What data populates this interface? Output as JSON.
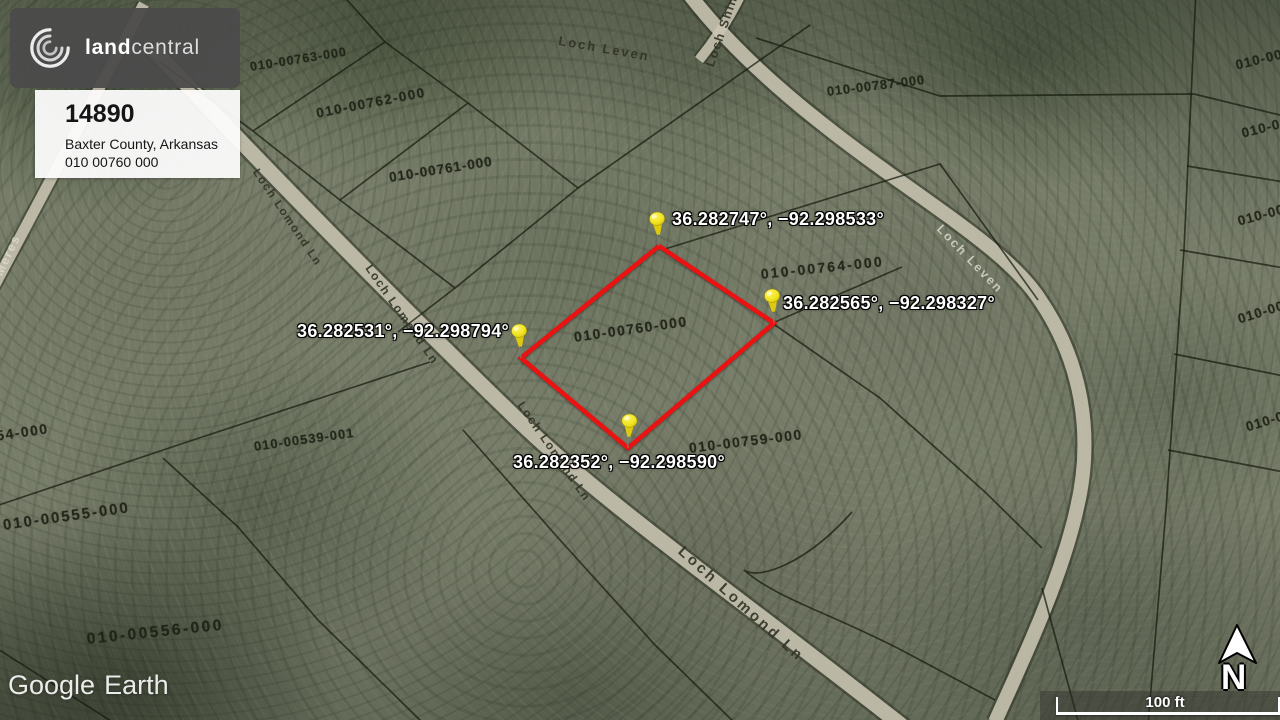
{
  "branding": {
    "logo_text_bold": "land",
    "logo_text_light": "central"
  },
  "listing": {
    "number": "14890",
    "location": "Baxter County, Arkansas",
    "parcel_id": "010 00760 000"
  },
  "pins": [
    {
      "id": "north",
      "coords": "36.282747°, −92.298533°"
    },
    {
      "id": "east",
      "coords": "36.282565°, −92.298327°"
    },
    {
      "id": "west",
      "coords": "36.282531°, −92.298794°"
    },
    {
      "id": "south",
      "coords": "36.282352°, −92.298590°"
    }
  ],
  "parcel_labels": [
    {
      "text": "010-00763-000"
    },
    {
      "text": "010-00762-000"
    },
    {
      "text": "010-00761-000"
    },
    {
      "text": "010-00787-000"
    },
    {
      "text": "010-00764-000"
    },
    {
      "text": "010-00760-000"
    },
    {
      "text": "010-00759-000"
    },
    {
      "text": "010-00539-001"
    },
    {
      "text": "010-00555-000"
    },
    {
      "text": "010-00556-000"
    },
    {
      "text": "554-000"
    },
    {
      "text": "010-00"
    },
    {
      "text": "010-00"
    },
    {
      "text": "010-00"
    },
    {
      "text": "010-00"
    },
    {
      "text": "010-00"
    }
  ],
  "road_labels": [
    {
      "text": "Loch Leven"
    },
    {
      "text": "Loch Shin"
    },
    {
      "text": "Loch Lomond Ln"
    },
    {
      "text": "Loch Lomond Ln"
    },
    {
      "text": "Loch Lomond Ln"
    },
    {
      "text": "Loch Lomond Ln"
    },
    {
      "text": "Loch Lomond Ln"
    },
    {
      "text": "Loch Leven"
    },
    {
      "text": "Meres"
    }
  ],
  "watermark": {
    "part1": "Google",
    "part2": "Earth"
  },
  "scale": {
    "label": "100 ft"
  },
  "compass": {
    "label": "N"
  },
  "colors": {
    "parcel_outline": "#ec1212",
    "pin_yellow": "#f2e320",
    "coord_text": "#ffffff"
  }
}
